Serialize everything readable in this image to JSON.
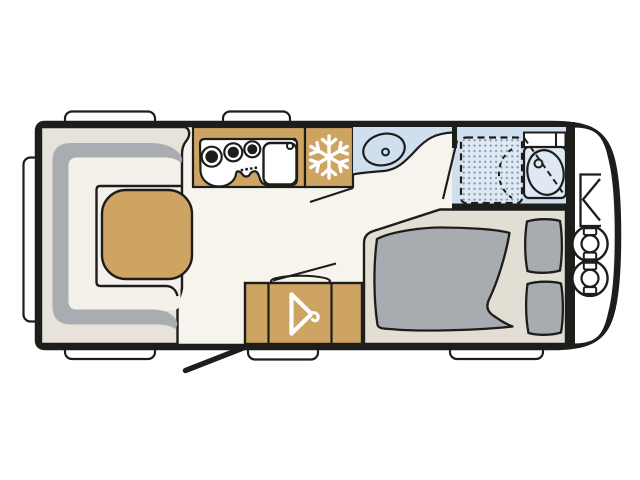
{
  "floorplan": {
    "vehicle": "caravan",
    "areas": [
      {
        "name": "lounge",
        "furniture": [
          "u-shaped-seating",
          "table"
        ]
      },
      {
        "name": "kitchen",
        "furniture": [
          "hob-with-3-burners",
          "sink",
          "refrigerator"
        ]
      },
      {
        "name": "washroom",
        "furniture": [
          "washbasin",
          "shower-tray",
          "toilet"
        ]
      },
      {
        "name": "bedroom",
        "furniture": [
          "double-bed",
          "duvet",
          "pillows"
        ]
      },
      {
        "name": "wardrobe",
        "furniture": [
          "clothes-hanger"
        ]
      },
      {
        "name": "front-locker",
        "furniture": [
          "gas-bottles",
          "locker-door"
        ]
      }
    ],
    "icons": [
      "snowflake-icon",
      "hanger-icon",
      "gas-bottle-icon"
    ],
    "counts": {
      "hob_burners": 3,
      "gas_bottles": 2,
      "pillows": 2,
      "window_bumps": 4,
      "doors": 2
    }
  },
  "colors": {
    "ink": "#1d1d1b",
    "floor": "#f7f4ed",
    "seat_base": "#e7e3da",
    "cushion": "#f4f1ea",
    "gray": "#a9adb2",
    "tan": "#cea463",
    "blue": "#cfdfee",
    "blue_light": "#dfe9f4",
    "dot_blue": "#7e96ae",
    "bed_base": "#e2ded3",
    "duvet": "#a8acb0",
    "white": "#ffffff"
  }
}
